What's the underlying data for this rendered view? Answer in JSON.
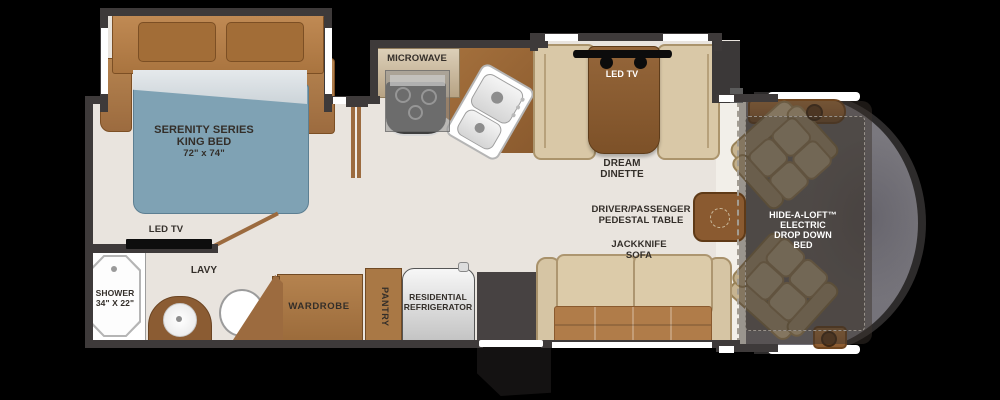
{
  "floorplan": {
    "bedroom": {
      "series": "SERENITY SERIES",
      "bed": "KING BED",
      "dims": "72\" x 74\"",
      "tv": "LED TV"
    },
    "bath": {
      "shower": "SHOWER",
      "shower_dims": "34\" X 22\"",
      "lavy": "LAVY"
    },
    "kitchen": {
      "microwave": "MICROWAVE"
    },
    "storage": {
      "wardrobe": "WARDROBE",
      "pantry": "PANTRY",
      "fridge1": "RESIDENTIAL",
      "fridge2": "REFRIGERATOR"
    },
    "dinette": {
      "tv": "LED TV",
      "name1": "DREAM",
      "name2": "DINETTE"
    },
    "living": {
      "table1": "DRIVER/PASSENGER",
      "table2": "PEDESTAL TABLE",
      "sofa1": "JACKKNIFE",
      "sofa2": "SOFA"
    },
    "cab": {
      "loft1": "HIDE-A-LOFT™",
      "loft2": "ELECTRIC",
      "loft3": "DROP DOWN",
      "loft4": "BED"
    }
  },
  "colors": {
    "background": "#000000",
    "floor": "#e9e4de",
    "wall": "#3e3a3a",
    "wood": "#9c6b3f",
    "mattress": "#7fa2b4",
    "cushion": "#d9c8a7",
    "sofa_seat": "#b07c49",
    "cab_gray": "#76747a"
  }
}
